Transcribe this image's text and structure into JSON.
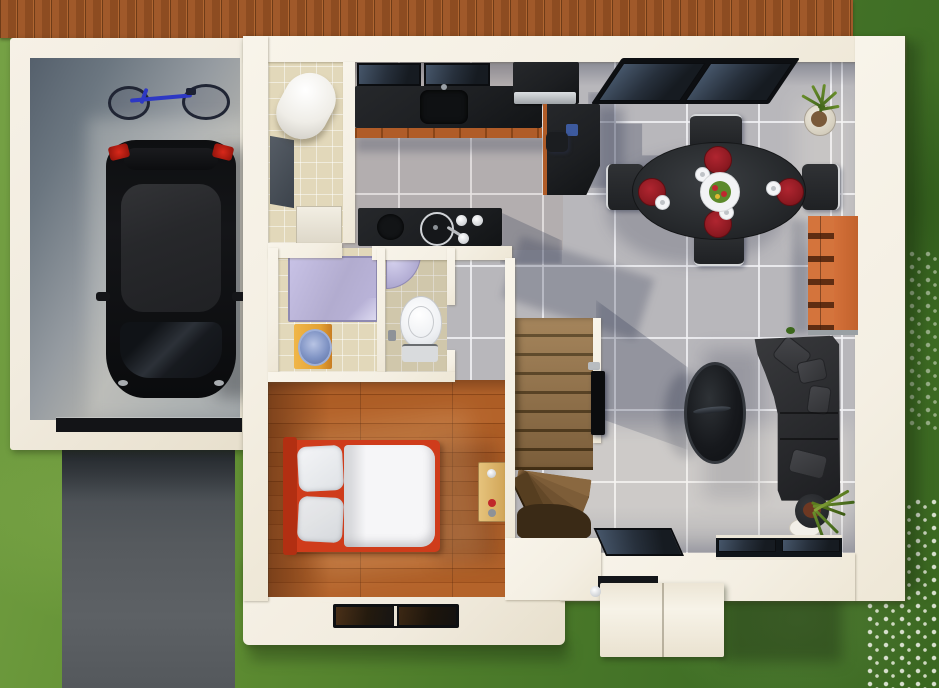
{
  "scene": {
    "title": "3D architectural rendering — top-down ground-floor plan of a house with garage, open-plan kitchen/dining/living area, bedroom, bathroom and WC",
    "view": "top-down",
    "style": "photoreal 3D floor plan visualization",
    "render_size": {
      "width": 939,
      "height": 688
    }
  },
  "palette": {
    "grass": "#4e7d2b",
    "deck": "#a0592a",
    "slab": "#f1ebde",
    "wall": "#f4efe3",
    "asphalt": "#565a5e",
    "tile": "#b8b7bb",
    "beige": "#e2d8ba",
    "wood": "#a9591f",
    "black": "#1d1f22",
    "sofa": "#2b2c2f",
    "bedred": "#cf3c1b",
    "matred": "#8e1a22",
    "shelf": "#d4743c",
    "cabinet": "#b05c28",
    "shower": "#b2accf",
    "vanity": "#e3a132",
    "basin": "#7f93c4",
    "bike": "#2d38c4"
  },
  "exterior": {
    "areas": [
      "lawn",
      "wood-deck",
      "asphalt-driveway",
      "entry-porch-canopy",
      "terrace-slab",
      "flower-patches"
    ]
  },
  "rooms": [
    {
      "name": "garage",
      "floor": "concrete",
      "contents": [
        "black-hatchback-car",
        "bicycle",
        "garage-door"
      ]
    },
    {
      "name": "utility-room",
      "floor": "beige-tile",
      "contents": [
        "water-heater-cylinder",
        "washing-machine",
        "white-cabinet"
      ]
    },
    {
      "name": "kitchen",
      "floor": "gray-tile",
      "contents": [
        "wall-counter-with-sink",
        "window-panes",
        "cooker-with-steel-hood",
        "tall-side-counter",
        "island-with-cooktop",
        "stool",
        "blue-bin"
      ]
    },
    {
      "name": "dining-area",
      "floor": "gray-tile",
      "contents": [
        "oval-black-table",
        "four-chairs",
        "four-red-placemats",
        "four-saucers",
        "salad-centerpiece",
        "skylight-window",
        "potted-plant",
        "orange-shelving-unit"
      ]
    },
    {
      "name": "living-room",
      "floor": "gray-tile",
      "contents": [
        "l-shaped-dark-sofa",
        "throw-cushions",
        "oval-coffee-table",
        "tv-on-stair-wall",
        "potted-plant",
        "south-windows",
        "entry-door"
      ]
    },
    {
      "name": "hallway",
      "floor": "gray-tile",
      "contents": [
        "winder-staircase"
      ]
    },
    {
      "name": "bathroom",
      "floor": "beige-tile",
      "contents": [
        "glass-shower",
        "yellow-vanity-with-blue-basin"
      ]
    },
    {
      "name": "wc",
      "floor": "beige-tile",
      "contents": [
        "toilet",
        "corner-sink",
        "waste-bin"
      ]
    },
    {
      "name": "bedroom",
      "floor": "wood-planks",
      "contents": [
        "double-bed-red-frame",
        "two-pillows",
        "white-duvet",
        "desk",
        "south-window"
      ]
    }
  ]
}
